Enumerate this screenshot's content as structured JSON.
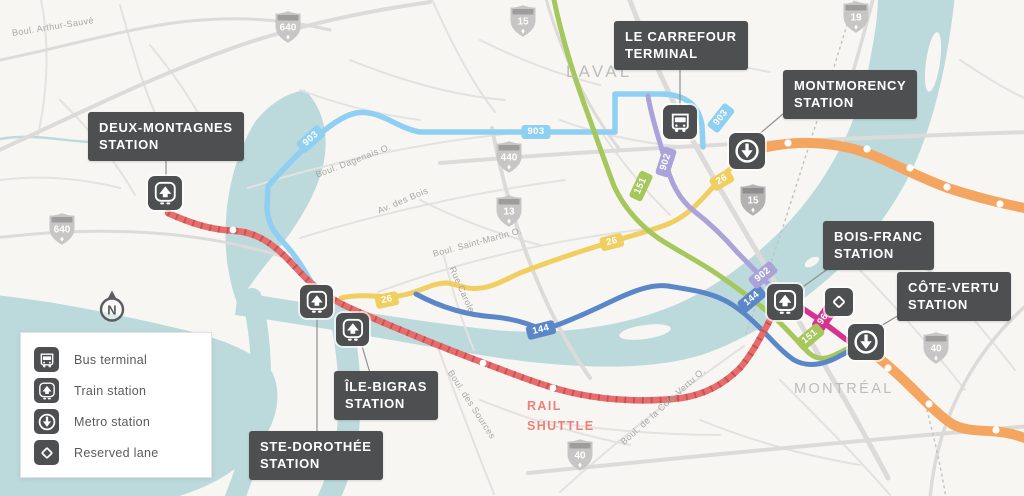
{
  "colors": {
    "water": "#bcd9dc",
    "land": "#f7f6f3",
    "label_box": "#4e4f51",
    "route_903": "#8fd0f2",
    "route_902": "#aaa3d9",
    "route_151": "#a5c75b",
    "route_26": "#f0ce5f",
    "route_144": "#5b87c9",
    "route_964": "#d63391",
    "rail_shuttle_line": "#e86c6c",
    "metro_orange_line": "#f4a55f"
  },
  "city_labels": [
    {
      "name": "LAVAL"
    },
    {
      "name": "MONTRÉAL"
    }
  ],
  "stations": [
    {
      "line1": "DEUX-MONTAGNES",
      "line2": "STATION",
      "type": "train-station"
    },
    {
      "line1": "LE CARREFOUR",
      "line2": "TERMINAL",
      "type": "bus-terminal"
    },
    {
      "line1": "MONTMORENCY",
      "line2": "STATION",
      "type": "metro-station"
    },
    {
      "line1": "BOIS-FRANC",
      "line2": "STATION",
      "type": "train-station"
    },
    {
      "line1": "CÔTE-VERTU",
      "line2": "STATION",
      "type": "metro-station"
    },
    {
      "line1": "ÎLE-BIGRAS",
      "line2": "STATION",
      "type": "train-station"
    },
    {
      "line1": "STE-DOROTHÉE",
      "line2": "STATION",
      "type": "train-station"
    }
  ],
  "legend": {
    "items": [
      {
        "icon": "bus-terminal-icon",
        "label": "Bus terminal"
      },
      {
        "icon": "train-station-icon",
        "label": "Train station"
      },
      {
        "icon": "metro-station-icon",
        "label": "Metro station"
      },
      {
        "icon": "reserved-lane-icon",
        "label": "Reserved lane"
      }
    ]
  },
  "route_badges": [
    {
      "route": "903"
    },
    {
      "route": "903"
    },
    {
      "route": "903"
    },
    {
      "route": "902"
    },
    {
      "route": "151"
    },
    {
      "route": "26"
    },
    {
      "route": "26"
    },
    {
      "route": "26"
    },
    {
      "route": "144"
    },
    {
      "route": "144"
    },
    {
      "route": "902"
    },
    {
      "route": "964"
    },
    {
      "route": "151"
    }
  ],
  "highway_shields": [
    {
      "number": "640"
    },
    {
      "number": "15"
    },
    {
      "number": "19"
    },
    {
      "number": "440"
    },
    {
      "number": "13"
    },
    {
      "number": "15"
    },
    {
      "number": "640"
    },
    {
      "number": "40"
    },
    {
      "number": "40"
    }
  ],
  "street_labels": [
    {
      "name": "Boul. Arthur-Sauvé"
    },
    {
      "name": "Boul. Dagenais O."
    },
    {
      "name": "Av. des Bois"
    },
    {
      "name": "Boul. Saint-Martin O."
    },
    {
      "name": "Rue Carole"
    },
    {
      "name": "Boul. des Sources"
    },
    {
      "name": "Boul. de la Côte-Vertu O."
    }
  ],
  "rail_shuttle": {
    "line1": "RAIL",
    "line2": "SHUTTLE"
  },
  "compass": {
    "letter": "N"
  }
}
